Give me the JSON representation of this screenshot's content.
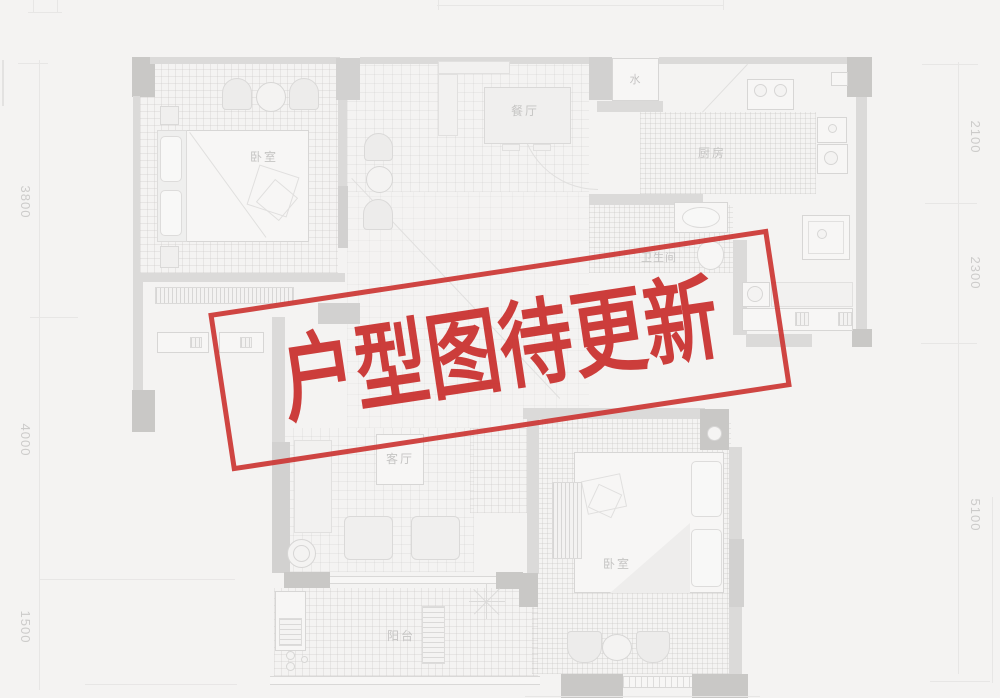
{
  "stamp": {
    "text": "户型图待更新",
    "color": "#cb3735"
  },
  "floorplan": {
    "rooms": [
      {
        "id": "bedroom-1",
        "label": "卧室"
      },
      {
        "id": "dining",
        "label": "餐厅"
      },
      {
        "id": "kitchen",
        "label": "厨房"
      },
      {
        "id": "bathroom",
        "label": "卫生间"
      },
      {
        "id": "living",
        "label": "客厅"
      },
      {
        "id": "balcony",
        "label": "阳台"
      },
      {
        "id": "bedroom-2",
        "label": "卧室"
      },
      {
        "id": "water-riser",
        "label": "水"
      }
    ],
    "dimensions_left": [
      {
        "value": "3800"
      },
      {
        "value": "4000"
      },
      {
        "value": "1500"
      }
    ],
    "dimensions_right": [
      {
        "value": "2100"
      },
      {
        "value": "2300"
      },
      {
        "value": "5100"
      }
    ]
  }
}
